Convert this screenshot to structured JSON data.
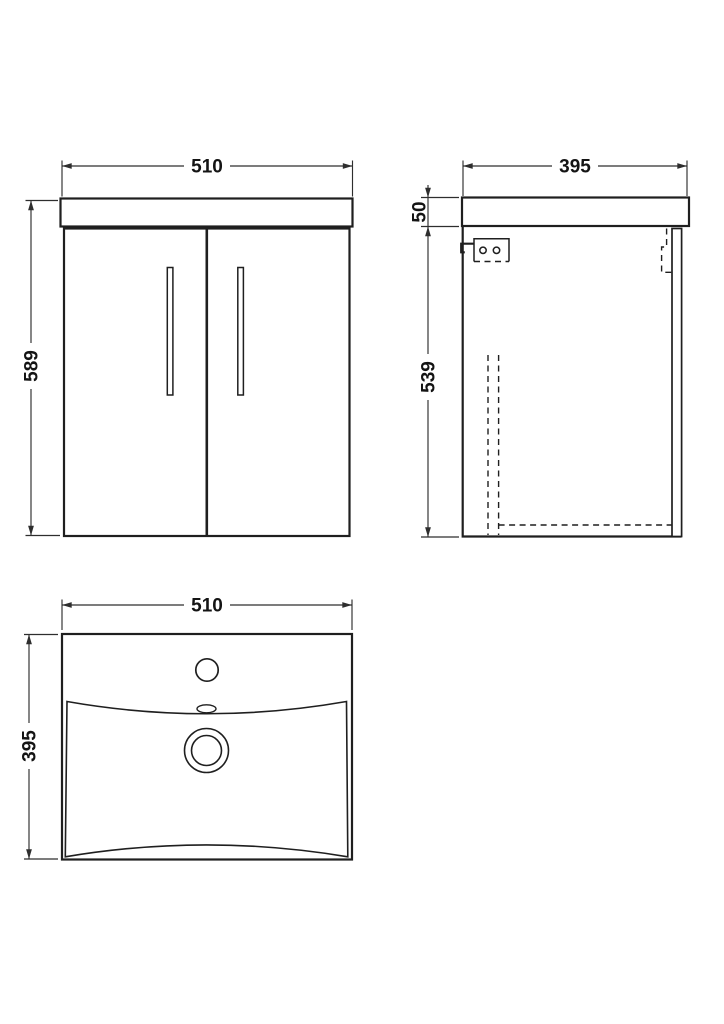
{
  "colors": {
    "line": "#1f1f1f",
    "dim": "#2e2e2e",
    "bg": "#ffffff",
    "text": "#141414"
  },
  "views": {
    "front": {
      "width_label": "510",
      "height_label": "589"
    },
    "side": {
      "depth_label": "395",
      "worktop_label": "50",
      "height_label": "539"
    },
    "plan": {
      "width_label": "510",
      "depth_label": "395"
    }
  }
}
